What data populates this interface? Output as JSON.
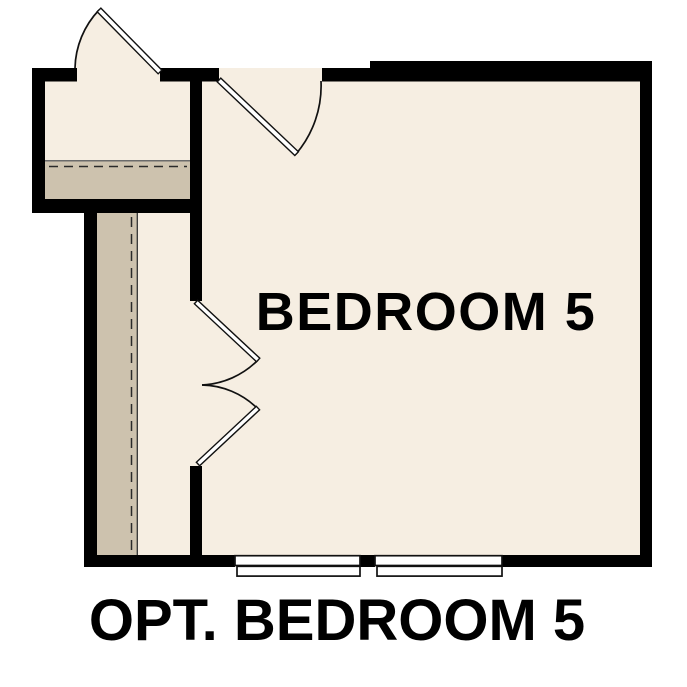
{
  "plan": {
    "room_label": "BEDROOM 5",
    "caption": "OPT. BEDROOM 5",
    "colors": {
      "floor": "#f6eee2",
      "feature_floor": "#cdc2ae",
      "wall": "#000000",
      "door_leaf": "#ffffff",
      "background": "#ffffff",
      "text": "#000000"
    },
    "elements": {
      "doors": [
        "hinged-door-top-left",
        "hinged-door-top-center",
        "bifold-door-left"
      ],
      "windows": [
        "window-bottom-left",
        "window-bottom-right"
      ],
      "features": [
        "stair-band-upper-left",
        "stair-strip-left-corridor"
      ]
    }
  }
}
